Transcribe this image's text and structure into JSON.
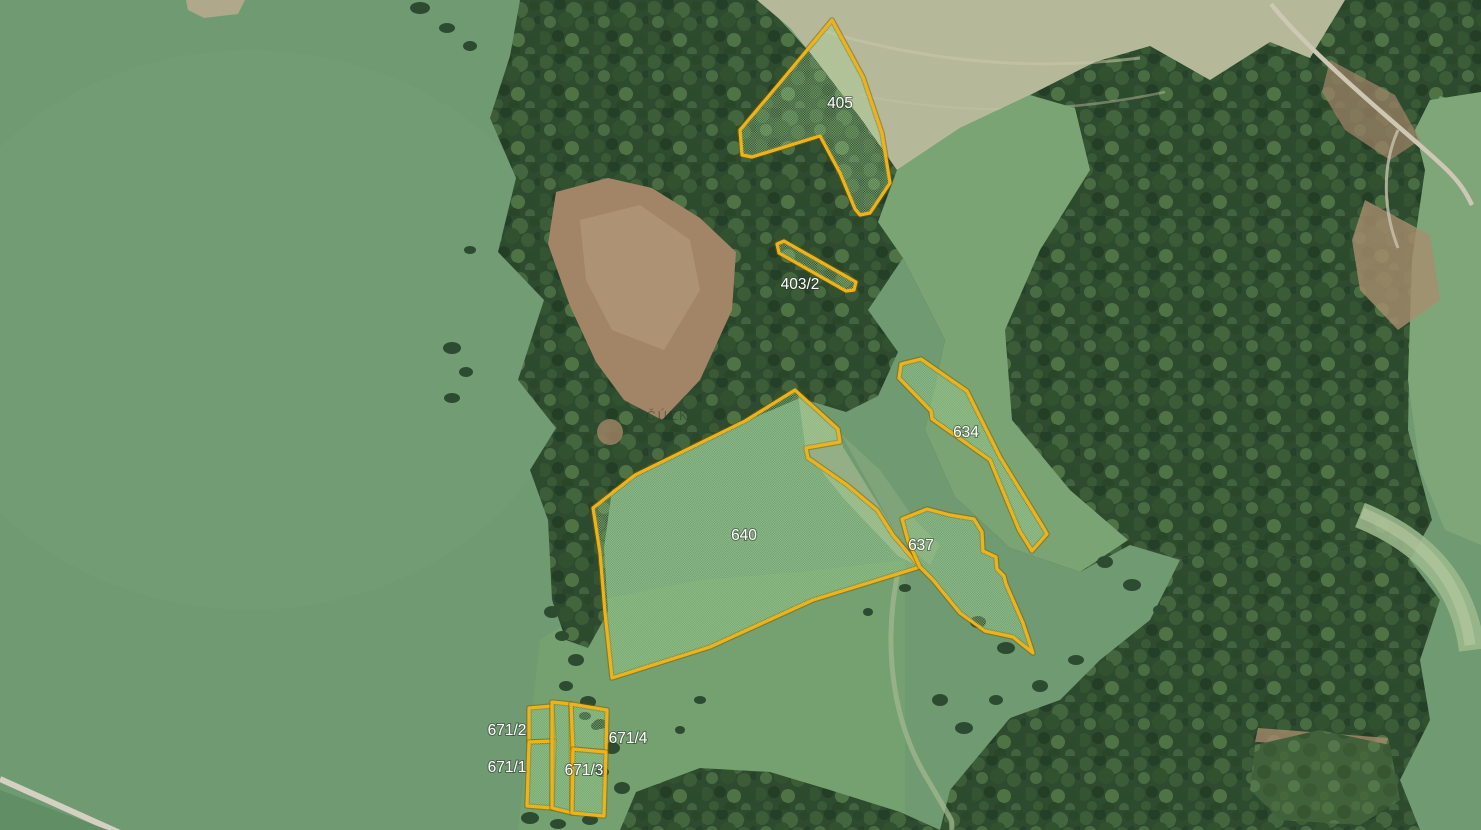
{
  "map": {
    "source_watermark": "ČÚZK",
    "colors": {
      "parcel_border": "#ecb31d",
      "parcel_border_shadow": "#7c5e00",
      "parcel_fill": "#a8da97",
      "label_text": "#ffffff"
    },
    "parcels": [
      {
        "id": "405",
        "label": "405",
        "label_xy": [
          840,
          108
        ],
        "points": [
          [
            832,
            20
          ],
          [
            863,
            77
          ],
          [
            882,
            133
          ],
          [
            890,
            183
          ],
          [
            874,
            207
          ],
          [
            870,
            213
          ],
          [
            860,
            215
          ],
          [
            855,
            209
          ],
          [
            840,
            173
          ],
          [
            820,
            136
          ],
          [
            752,
            157
          ],
          [
            742,
            155
          ],
          [
            740,
            130
          ],
          [
            778,
            85
          ]
        ]
      },
      {
        "id": "403/2",
        "label": "403/2",
        "label_xy": [
          800,
          289
        ],
        "points": [
          [
            777,
            244
          ],
          [
            784,
            241
          ],
          [
            856,
            282
          ],
          [
            854,
            290
          ],
          [
            846,
            291
          ],
          [
            779,
            253
          ]
        ]
      },
      {
        "id": "634",
        "label": "634",
        "label_xy": [
          966,
          437
        ],
        "points": [
          [
            901,
            364
          ],
          [
            921,
            359
          ],
          [
            967,
            391
          ],
          [
            1000,
            457
          ],
          [
            1043,
            527
          ],
          [
            1047,
            534
          ],
          [
            1032,
            551
          ],
          [
            1019,
            530
          ],
          [
            990,
            460
          ],
          [
            959,
            438
          ],
          [
            939,
            424
          ],
          [
            932,
            419
          ],
          [
            931,
            411
          ],
          [
            899,
            378
          ]
        ]
      },
      {
        "id": "640",
        "label": "640",
        "label_xy": [
          744,
          540
        ],
        "points": [
          [
            795,
            390
          ],
          [
            838,
            429
          ],
          [
            840,
            442
          ],
          [
            806,
            448
          ],
          [
            808,
            458
          ],
          [
            847,
            485
          ],
          [
            877,
            510
          ],
          [
            893,
            535
          ],
          [
            920,
            567
          ],
          [
            813,
            600
          ],
          [
            710,
            647
          ],
          [
            612,
            678
          ],
          [
            605,
            613
          ],
          [
            600,
            553
          ],
          [
            593,
            508
          ],
          [
            635,
            475
          ],
          [
            745,
            421
          ]
        ]
      },
      {
        "id": "637",
        "label": "637",
        "label_xy": [
          921,
          550
        ],
        "points": [
          [
            902,
            519
          ],
          [
            927,
            509
          ],
          [
            950,
            515
          ],
          [
            974,
            519
          ],
          [
            982,
            532
          ],
          [
            983,
            551
          ],
          [
            996,
            557
          ],
          [
            997,
            569
          ],
          [
            1004,
            576
          ],
          [
            1006,
            584
          ],
          [
            1023,
            623
          ],
          [
            1033,
            653
          ],
          [
            1013,
            637
          ],
          [
            985,
            631
          ],
          [
            960,
            613
          ],
          [
            933,
            580
          ],
          [
            920,
            567
          ],
          [
            908,
            541
          ]
        ]
      },
      {
        "id": "671/2",
        "label": "671/2",
        "label_xy": [
          507,
          735
        ],
        "points": [
          [
            529,
            708
          ],
          [
            552,
            706
          ],
          [
            554,
            741
          ],
          [
            529,
            742
          ]
        ]
      },
      {
        "id": "671/1",
        "label": "671/1",
        "label_xy": [
          507,
          772
        ],
        "points": [
          [
            529,
            742
          ],
          [
            554,
            741
          ],
          [
            552,
            808
          ],
          [
            527,
            806
          ]
        ]
      },
      {
        "id": "671-strip",
        "label": "",
        "label_xy": null,
        "points": [
          [
            552,
            702
          ],
          [
            571,
            704
          ],
          [
            572,
            813
          ],
          [
            552,
            808
          ]
        ]
      },
      {
        "id": "671/4",
        "label": "671/4",
        "label_xy": [
          628,
          743
        ],
        "points": [
          [
            571,
            704
          ],
          [
            607,
            710
          ],
          [
            606,
            752
          ],
          [
            573,
            749
          ]
        ]
      },
      {
        "id": "671/3",
        "label": "671/3",
        "label_xy": [
          584,
          775
        ],
        "points": [
          [
            573,
            749
          ],
          [
            606,
            752
          ],
          [
            604,
            816
          ],
          [
            572,
            813
          ]
        ]
      }
    ]
  }
}
